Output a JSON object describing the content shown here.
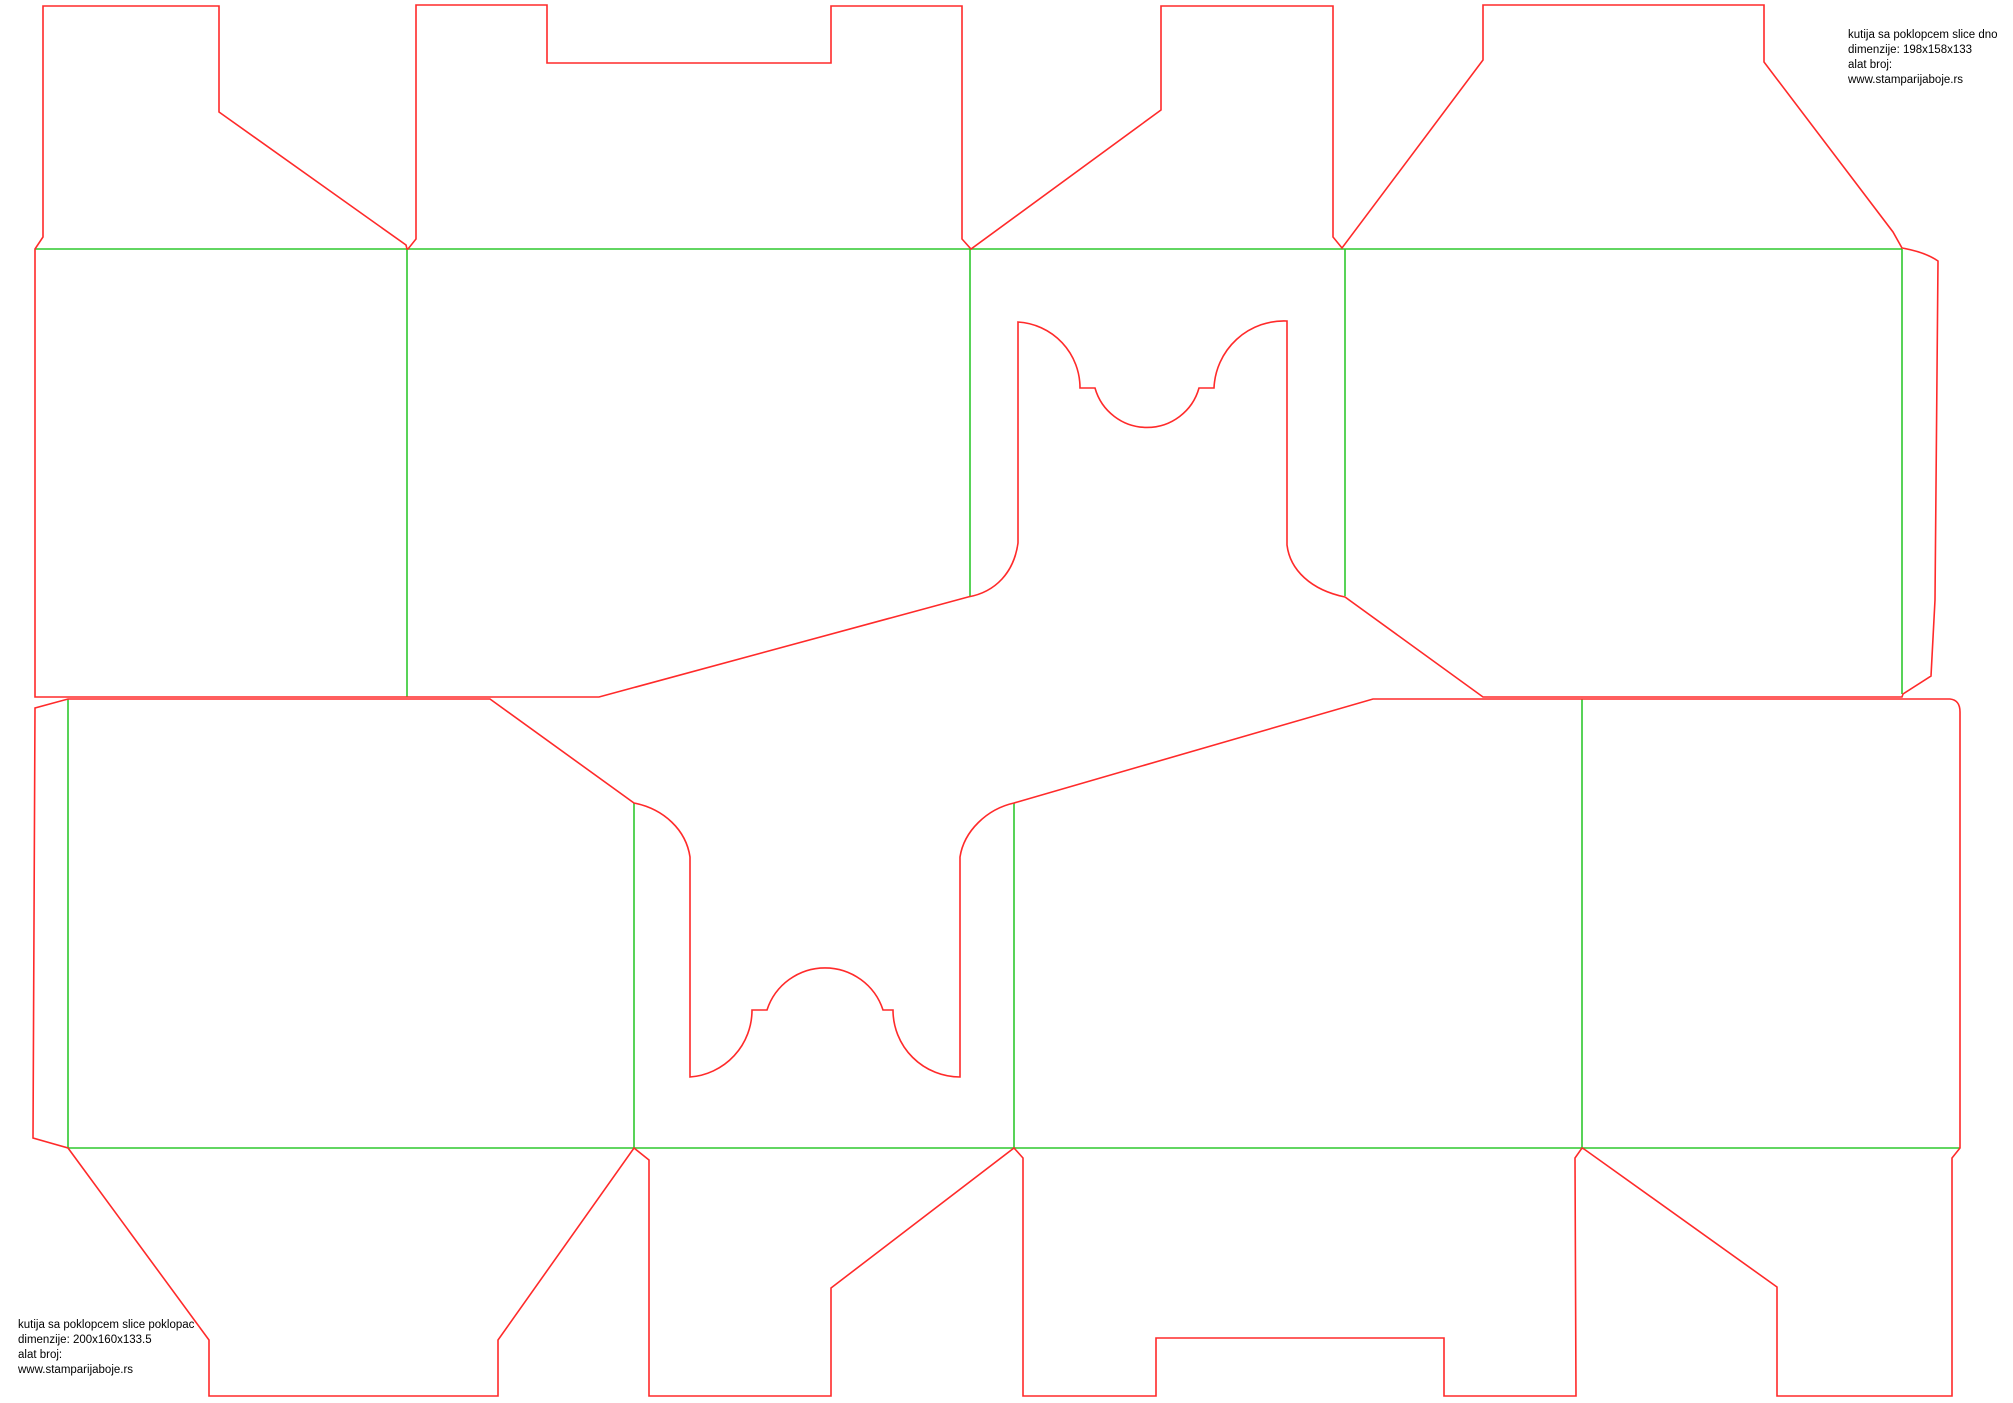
{
  "canvas": {
    "width": 2013,
    "height": 1403,
    "background": "#ffffff"
  },
  "colors": {
    "cut": "#ff2a2a",
    "crease": "#2ec82e",
    "text": "#000000"
  },
  "labels": {
    "dno": {
      "text": "kutija sa poklopcem slice dno\ndimenzije: 198x158x133\nalat broj:\nwww.stamparijaboje.rs",
      "x": 1848,
      "y": 28
    },
    "poklopac": {
      "text": "kutija sa poklopcem slice poklopac\ndimenzije: 200x160x133.5\nalat broj:\nwww.stamparijaboje.rs",
      "x": 18,
      "y": 1318
    }
  },
  "dielines": [
    {
      "id": "dno",
      "title": "kutija sa poklopcem slice dno",
      "cut": "M 35 249 L 43 237 L 43 6 L 219 6 L 219 112 L 406 245 L 407 249 L 408 249 L 416 239 L 416 5 L 547 5 L 547 63 L 831 63 L 831 6 L 962 6 L 962 239 L 971 249 L 1161 110 L 1161 6 L 1333 6 L 1333 237 L 1342 248 L 1483 60 L 1483 5 L 1764 5 L 1764 62 L 1893 232 L 1902 248 Q 1925 252 1938 261 L 1935 600 L 1931 676 L 1903 694 L 1902 697 L 1483 697 L 1345 597 C 1311 590 1290 570 1287 545 L 1287 321 A 70 70 0 0 0 1214 388 L 1199 388 A 54 54 0 0 1 1095 388 L 1080 388 A 66 66 0 0 0 1018 322 L 1018 543 C 1014 572 996 592 968 597 L 599 697 L 35 697 Z",
      "creases": [
        "M 35 249 L 1902 249",
        "M 407 249 L 407 697",
        "M 970 249 L 970 597",
        "M 1345 249 L 1345 596",
        "M 1902 249 L 1902 694"
      ]
    },
    {
      "id": "poklopac",
      "title": "kutija sa poklopcem slice poklopac",
      "cut": "M 68 699 L 490 699 L 634 803 C 664 809 686 830 690 857 L 690 1077 A 67 67 0 0 0 752 1010 L 767 1010 A 61 61 0 0 1 883 1010 L 893 1010 A 67 67 0 0 0 960 1077 L 960 857 C 964 831 987 809 1014 803 L 1373 699 L 1950 699 Q 1960 700 1960 712 L 1960 1148 L 1952 1158 L 1952 1396 L 1777 1396 L 1777 1287 L 1584 1149 L 1582 1148 L 1575 1158 L 1576 1396 L 1444 1396 L 1444 1338 L 1156 1338 L 1156 1396 L 1023 1396 L 1023 1158 L 1014 1148 L 831 1288 L 831 1396 L 649 1396 L 649 1160 L 634 1148 L 498 1340 L 498 1396 L 209 1396 L 209 1340 L 68 1148 L 33 1138 L 35 708 Z",
      "creases": [
        "M 68 1148 L 1960 1148",
        "M 68 699 L 68 1148",
        "M 634 803 L 634 1148",
        "M 1014 803 L 1014 1148",
        "M 1582 699 L 1582 1148"
      ]
    }
  ]
}
